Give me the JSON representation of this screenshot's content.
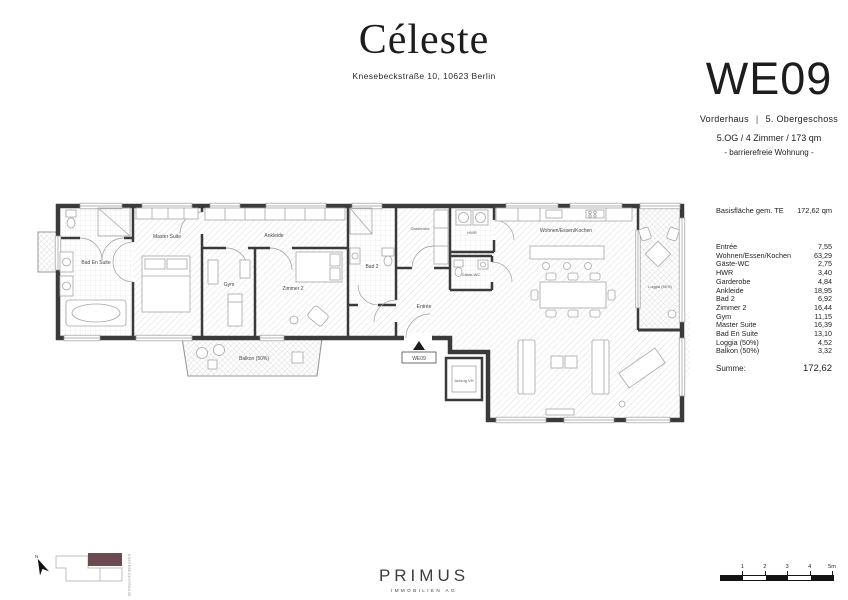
{
  "header": {
    "project": "Céleste",
    "address": "Knesebeckstraße 10, 10623 Berlin"
  },
  "unit": {
    "id": "WE09",
    "building": "Vorderhaus",
    "separator": "|",
    "floor": "5. Obergeschoss",
    "summary": "5.OG / 4 Zimmer / 173 qm",
    "note": "- barrierefreie Wohnung -"
  },
  "area_table": {
    "header_label": "Basisfläche gem. TE",
    "header_value": "172,62 qm",
    "rows": [
      {
        "label": "Entrée",
        "value": "7,55"
      },
      {
        "label": "Wohnen/Essen/Kochen",
        "value": "63,29"
      },
      {
        "label": "Gäste-WC",
        "value": "2,75"
      },
      {
        "label": "HWR",
        "value": "3,40"
      },
      {
        "label": "Garderobe",
        "value": "4,84"
      },
      {
        "label": "Ankleide",
        "value": "18,95"
      },
      {
        "label": "Bad 2",
        "value": "6,92"
      },
      {
        "label": "Zimmer 2",
        "value": "16,44"
      },
      {
        "label": "Gym",
        "value": "11,15"
      },
      {
        "label": "Master Suite",
        "value": "16,39"
      },
      {
        "label": "Bad En Suite",
        "value": "13,10"
      },
      {
        "label": "Loggia (50%)",
        "value": "4,52"
      },
      {
        "label": "Balkon (50%)",
        "value": "3,32"
      }
    ],
    "sum_label": "Summe:",
    "sum_value": "172,62"
  },
  "plan": {
    "rooms": {
      "bad_en_suite": "Bad En Suite",
      "master_suite": "Master Suite",
      "gym": "Gym",
      "zimmer2": "Zimmer 2",
      "ankleide": "Ankleide",
      "bad2": "Bad 2",
      "garderobe": "Garderobe",
      "entree": "Entrée",
      "gaeste_wc": "Gäste-WC",
      "hwr": "HWR",
      "wohnen": "Wohnen/Essen/Kochen",
      "loggia": "Loggia (50%)",
      "balkon": "Balkon (50%)",
      "aufzug": "Aufzug VH",
      "entrance_marker": "WE09"
    },
    "wall_color": "#3a3a3a"
  },
  "site_key": {
    "north_label": "N",
    "street_label": "KNESEBECKSTRASSE",
    "highlight_color": "#6b4a50"
  },
  "footer": {
    "brand": "PRIMUS",
    "brand_sub": "IMMOBILIEN AG"
  },
  "scale_bar": {
    "ticks": [
      "1",
      "2",
      "3",
      "4",
      "5m"
    ]
  }
}
